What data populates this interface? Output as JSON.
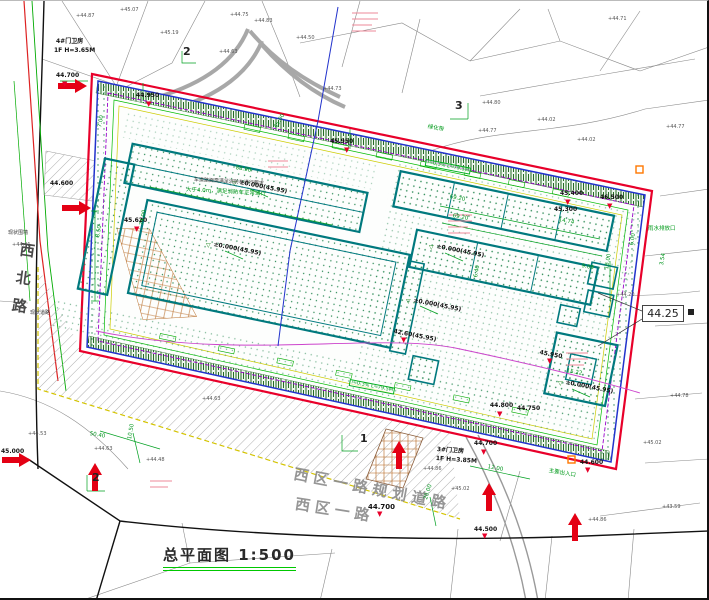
{
  "colors": {
    "site_boundary_red": "#e8002a",
    "setback_blue": "#2233cc",
    "utility_purple": "#9900cc",
    "dimension_green": "#00a020",
    "building_teal": "#00797e",
    "hatch_yellow": "#d4c400",
    "pipeline_magenta": "#cc44cc",
    "arrow_red": "#e40014"
  },
  "title": {
    "text": "总平面图 1:500"
  },
  "roads": {
    "vertical_road": "西北路",
    "planned_road": "西区一路规划道路",
    "west_road": "西区一路"
  },
  "elevation_box": {
    "value": "44.25"
  },
  "section_marks": {
    "items": [
      {
        "t": "2",
        "x": 183,
        "y": 45
      },
      {
        "t": "3",
        "x": 455,
        "y": 99
      },
      {
        "t": "2",
        "x": 92,
        "y": 471
      },
      {
        "t": "1",
        "x": 360,
        "y": 432
      }
    ]
  },
  "gatehouses": {
    "items": [
      {
        "t": "4#门卫房",
        "x": 56,
        "y": 38
      },
      {
        "t": "1F H=3.65M",
        "x": 54,
        "y": 47
      },
      {
        "t": "3#门卫房",
        "x": 437,
        "y": 446,
        "r": 4
      },
      {
        "t": "1F H=3.85M",
        "x": 436,
        "y": 455,
        "r": 4
      }
    ]
  },
  "level_labels": {
    "items": [
      {
        "t": "±0.000(45.95)",
        "x": 240,
        "y": 179,
        "r": 11
      },
      {
        "t": "±0.000(45.95)",
        "x": 214,
        "y": 241,
        "r": 11
      },
      {
        "t": "±0.000(45.95)",
        "x": 437,
        "y": 243,
        "r": 11
      },
      {
        "t": "±0.000(45.95)",
        "x": 414,
        "y": 297,
        "r": 11
      },
      {
        "t": "±0.000(45.95)",
        "x": 566,
        "y": 379,
        "r": 11
      }
    ]
  },
  "elevations": {
    "items": [
      {
        "t": "44.700",
        "x": 56,
        "y": 72
      },
      {
        "t": "44.950",
        "x": 136,
        "y": 92
      },
      {
        "t": "45.950",
        "x": 330,
        "y": 138
      },
      {
        "t": "45.620",
        "x": 124,
        "y": 217
      },
      {
        "t": "44.600",
        "x": 50,
        "y": 180
      },
      {
        "t": "45.400",
        "x": 560,
        "y": 190
      },
      {
        "t": "46.500",
        "x": 600,
        "y": 194
      },
      {
        "t": "45.300",
        "x": 554,
        "y": 206
      },
      {
        "t": "44.800",
        "x": 490,
        "y": 402
      },
      {
        "t": "44.750",
        "x": 517,
        "y": 405
      },
      {
        "t": "44.700",
        "x": 474,
        "y": 440
      },
      {
        "t": "44.700",
        "x": 368,
        "y": 503,
        "s": 7
      },
      {
        "t": "44.600",
        "x": 580,
        "y": 459
      },
      {
        "t": "45.000",
        "x": 1,
        "y": 448
      },
      {
        "t": "44.500",
        "x": 474,
        "y": 526
      },
      {
        "t": "42.60(45.95)",
        "x": 394,
        "y": 328,
        "r": 11
      },
      {
        "t": "45.950",
        "x": 540,
        "y": 349,
        "r": 11
      }
    ]
  },
  "triangles": {
    "items": [
      {
        "t": "▼",
        "x": 146,
        "y": 100
      },
      {
        "t": "▼",
        "x": 344,
        "y": 146
      },
      {
        "t": "▼",
        "x": 134,
        "y": 225
      },
      {
        "t": "▼",
        "x": 565,
        "y": 198
      },
      {
        "t": "▼",
        "x": 607,
        "y": 202
      },
      {
        "t": "▼",
        "x": 497,
        "y": 410
      },
      {
        "t": "▼",
        "x": 481,
        "y": 448
      },
      {
        "t": "▼",
        "x": 377,
        "y": 510
      },
      {
        "t": "▼",
        "x": 585,
        "y": 466
      },
      {
        "t": "▼",
        "x": 482,
        "y": 532
      },
      {
        "t": "▼",
        "x": 401,
        "y": 336
      },
      {
        "t": "▼",
        "x": 547,
        "y": 357
      },
      {
        "t": "▼",
        "x": 62,
        "y": 80
      }
    ]
  },
  "open_triangles": {
    "items": [
      {
        "t": "▽",
        "x": 232,
        "y": 180
      },
      {
        "t": "▽",
        "x": 206,
        "y": 242
      },
      {
        "t": "▽",
        "x": 429,
        "y": 244
      },
      {
        "t": "▽",
        "x": 406,
        "y": 298
      },
      {
        "t": "▽",
        "x": 558,
        "y": 380
      }
    ]
  },
  "spot_elevations": {
    "items": [
      {
        "t": "+44.87",
        "x": 76,
        "y": 13
      },
      {
        "t": "+45.07",
        "x": 120,
        "y": 7
      },
      {
        "t": "+45.19",
        "x": 160,
        "y": 30
      },
      {
        "t": "+44.75",
        "x": 230,
        "y": 12
      },
      {
        "t": "+44.83",
        "x": 254,
        "y": 18
      },
      {
        "t": "+44.50",
        "x": 296,
        "y": 35
      },
      {
        "t": "+44.73",
        "x": 323,
        "y": 86
      },
      {
        "t": "+44.63",
        "x": 219,
        "y": 49
      },
      {
        "t": "+44.80",
        "x": 482,
        "y": 100
      },
      {
        "t": "+44.77",
        "x": 478,
        "y": 128
      },
      {
        "t": "+44.02",
        "x": 537,
        "y": 117
      },
      {
        "t": "+44.02",
        "x": 577,
        "y": 137
      },
      {
        "t": "+44.71",
        "x": 608,
        "y": 16
      },
      {
        "t": "+44.77",
        "x": 666,
        "y": 124
      },
      {
        "t": "+44.20",
        "x": 616,
        "y": 292
      },
      {
        "t": "+44.78",
        "x": 670,
        "y": 393
      },
      {
        "t": "+45.02",
        "x": 643,
        "y": 440
      },
      {
        "t": "+43.59",
        "x": 662,
        "y": 504
      },
      {
        "t": "+44.86",
        "x": 588,
        "y": 517
      },
      {
        "t": "+44.86",
        "x": 423,
        "y": 466
      },
      {
        "t": "+45.02",
        "x": 451,
        "y": 486
      },
      {
        "t": "+44.63",
        "x": 94,
        "y": 446
      },
      {
        "t": "+44.48",
        "x": 146,
        "y": 457
      },
      {
        "t": "+44.53",
        "x": 28,
        "y": 431
      },
      {
        "t": "+44.63",
        "x": 202,
        "y": 396
      },
      {
        "t": "+44.41",
        "x": 12,
        "y": 242
      }
    ]
  },
  "dimensions": {
    "items": [
      {
        "t": "83.90",
        "x": 236,
        "y": 165,
        "r": 11
      },
      {
        "t": "69.20",
        "x": 450,
        "y": 194,
        "r": 11
      },
      {
        "t": "69.20",
        "x": 453,
        "y": 213,
        "r": 11
      },
      {
        "t": "74.00",
        "x": 140,
        "y": 224,
        "r": -79
      },
      {
        "t": "8.50",
        "x": 96,
        "y": 236,
        "r": -79
      },
      {
        "t": "6.40",
        "x": 474,
        "y": 276,
        "r": -79
      },
      {
        "t": "15.22",
        "x": 567,
        "y": 368,
        "r": 11
      },
      {
        "t": "16.00",
        "x": 605,
        "y": 268,
        "r": -80
      },
      {
        "t": "50.40",
        "x": 90,
        "y": 431,
        "r": 10
      },
      {
        "t": "10.50",
        "x": 128,
        "y": 438,
        "r": -80
      },
      {
        "t": "12.00",
        "x": 488,
        "y": 464,
        "r": 11
      },
      {
        "t": "20.00",
        "x": 424,
        "y": 498,
        "r": -72
      },
      {
        "t": "14.74",
        "x": 559,
        "y": 217,
        "r": 11
      },
      {
        "t": "6.00",
        "x": 630,
        "y": 244,
        "r": -80
      },
      {
        "t": "9.08",
        "x": 582,
        "y": 263,
        "r": 11
      },
      {
        "t": "3.54",
        "x": 660,
        "y": 264,
        "r": -80
      },
      {
        "t": "7.00",
        "x": 98,
        "y": 126,
        "r": -79
      },
      {
        "t": "45.00",
        "x": 274,
        "y": 126,
        "r": -60
      }
    ]
  },
  "notes_dark": {
    "items": [
      {
        "t": "车道路面需满足消防车通行要求",
        "x": 194,
        "y": 177,
        "r": 3
      },
      {
        "t": "现状围墙",
        "x": 8,
        "y": 230
      },
      {
        "t": "现状道路",
        "x": 30,
        "y": 310
      }
    ]
  },
  "notes_green": {
    "items": [
      {
        "t": "大于4.0m，满足消防车正常通行",
        "x": 186,
        "y": 187,
        "r": 3
      },
      {
        "t": "主要出入口",
        "x": 549,
        "y": 468,
        "r": 10
      },
      {
        "t": "雨水排放口",
        "x": 648,
        "y": 226
      },
      {
        "t": "绿化带",
        "x": 428,
        "y": 124,
        "r": 11
      }
    ]
  },
  "slope_notes": {
    "items": [
      {
        "t": "i=0.3% L=79.5M",
        "x": 426,
        "y": 158,
        "r": 11
      },
      {
        "t": "i=0.3% L=79.5M",
        "x": 350,
        "y": 378,
        "r": 11
      }
    ]
  }
}
